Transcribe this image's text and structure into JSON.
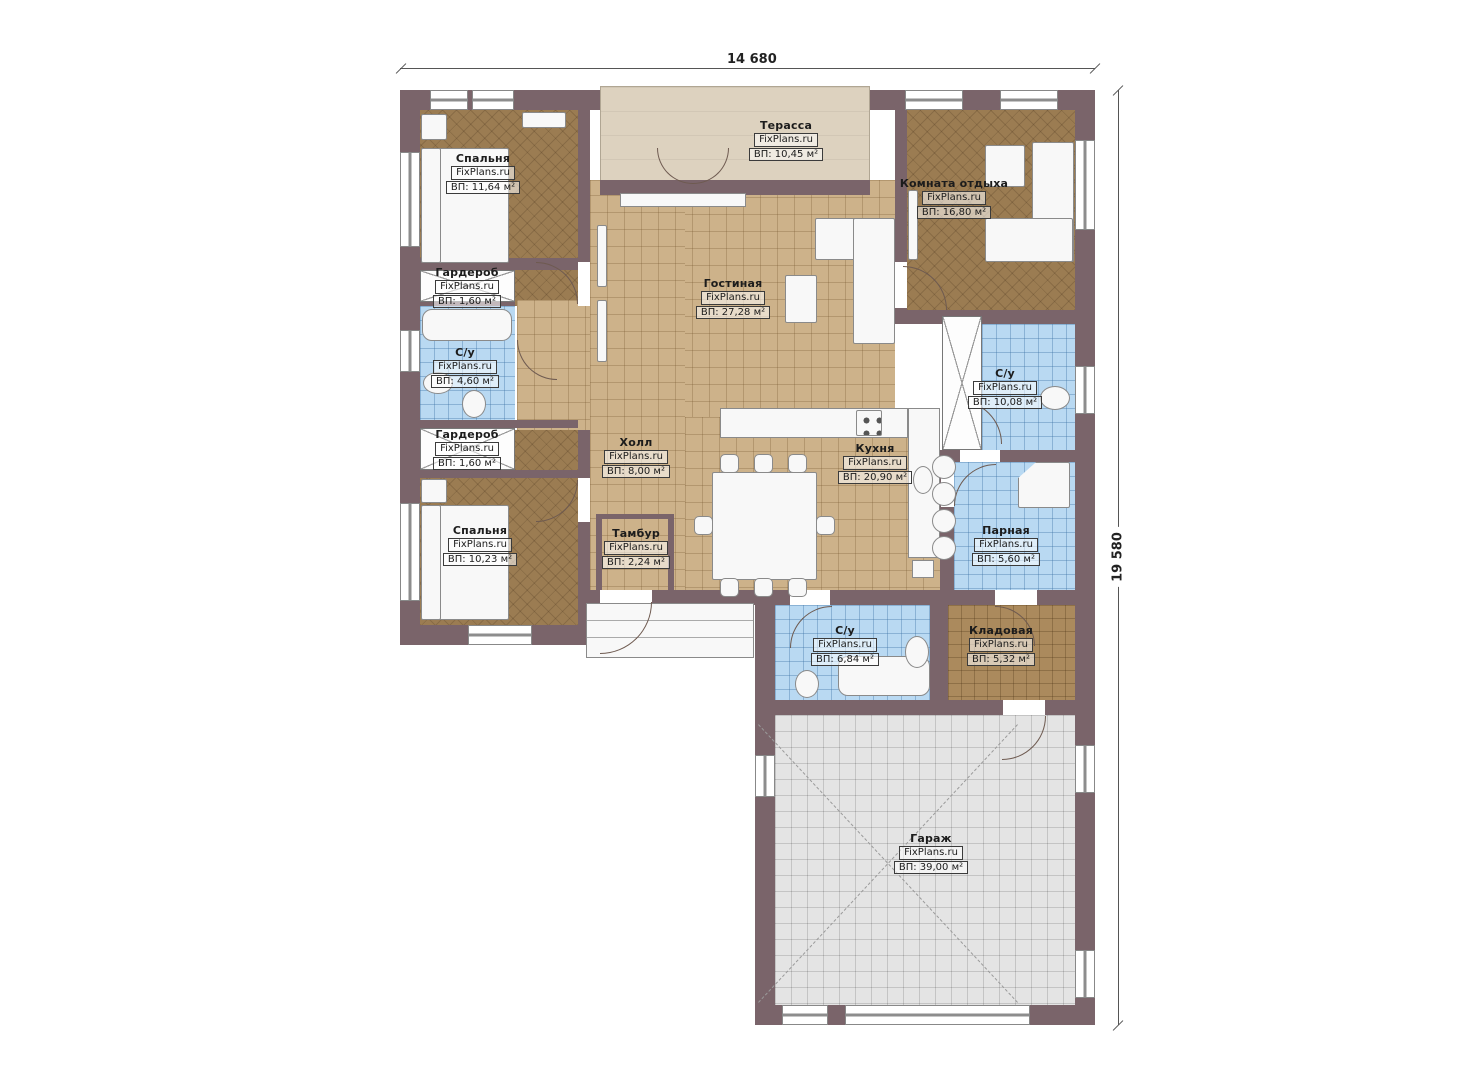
{
  "plan": {
    "dimensions": {
      "width_label": "14 680",
      "height_label": "19 580"
    },
    "rooms": [
      {
        "name": "Спальня",
        "brand": "FixPlans.ru",
        "area": "ВП: 11,64 м²"
      },
      {
        "name": "Терасса",
        "brand": "FixPlans.ru",
        "area": "ВП: 10,45 м²"
      },
      {
        "name": "Комната отдыха",
        "brand": "FixPlans.ru",
        "area": "ВП: 16,80 м²"
      },
      {
        "name": "Гостиная",
        "brand": "FixPlans.ru",
        "area": "ВП: 27,28 м²"
      },
      {
        "name": "Гардероб",
        "brand": "FixPlans.ru",
        "area": "ВП: 1,60 м²"
      },
      {
        "name": "С/у",
        "brand": "FixPlans.ru",
        "area": "ВП: 4,60 м²"
      },
      {
        "name": "Гардероб",
        "brand": "FixPlans.ru",
        "area": "ВП: 1,60 м²"
      },
      {
        "name": "Спальня",
        "brand": "FixPlans.ru",
        "area": "ВП: 10,23 м²"
      },
      {
        "name": "Холл",
        "brand": "FixPlans.ru",
        "area": "ВП: 8,00 м²"
      },
      {
        "name": "Кухня",
        "brand": "FixPlans.ru",
        "area": "ВП: 20,90 м²"
      },
      {
        "name": "С/у",
        "brand": "FixPlans.ru",
        "area": "ВП: 10,08 м²"
      },
      {
        "name": "Парная",
        "brand": "FixPlans.ru",
        "area": "ВП: 5,60 м²"
      },
      {
        "name": "Тамбур",
        "brand": "FixPlans.ru",
        "area": "ВП: 2,24 м²"
      },
      {
        "name": "С/у",
        "brand": "FixPlans.ru",
        "area": "ВП: 6,84 м²"
      },
      {
        "name": "Кладовая",
        "brand": "FixPlans.ru",
        "area": "ВП: 5,32 м²"
      },
      {
        "name": "Гараж",
        "brand": "FixPlans.ru",
        "area": "ВП: 39,00 м²"
      }
    ],
    "colors": {
      "wall": "#7a646a",
      "wood_floor": "#9b7c52",
      "tile_floor": "#cdb28a",
      "wet_floor": "#b9d9f2",
      "terrace_floor": "#ddd2bf",
      "storage_floor": "#ab8a5d",
      "garage_floor": "#e4e4e4"
    }
  }
}
